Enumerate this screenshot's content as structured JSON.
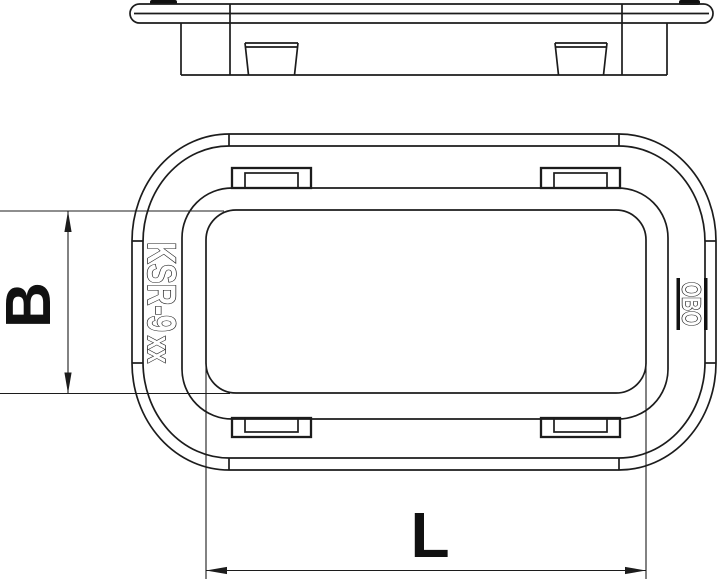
{
  "front_view": {
    "product_code": "KSR-9",
    "product_code_suffix": "xx",
    "logo_text": "OBO"
  },
  "dimensions": {
    "height_label": "B",
    "length_label": "L"
  },
  "colors": {
    "line": "#1c1c1c",
    "background": "#ffffff",
    "label": "#111111"
  }
}
